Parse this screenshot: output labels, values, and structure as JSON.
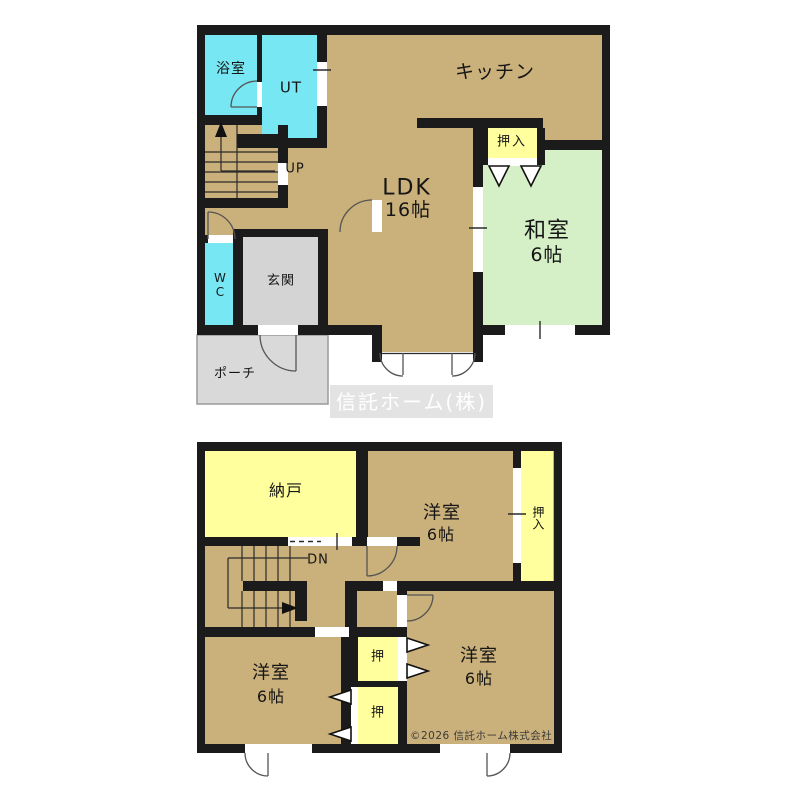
{
  "watermark": "信託ホーム(株)",
  "copyright": "©2026 信託ホーム株式会社",
  "colors": {
    "wall": "#1b1b1b",
    "room": "#cab07a",
    "water": "#77e7f4",
    "tatami": "#d5efc6",
    "closet": "#ffff9d",
    "entry": "#d4d4d4",
    "porch": "#d9d9d9"
  },
  "floor1": {
    "bath": "浴室",
    "utility": "UT",
    "kitchen": "キッチン",
    "closet": "押入",
    "washitsu": "和室",
    "washitsu_size": "6帖",
    "ldk": "LDK",
    "ldk_size": "16帖",
    "stairs_up": "UP",
    "wc": "WC",
    "entrance": "玄関",
    "porch": "ポーチ"
  },
  "floor2": {
    "storage": "納戸",
    "stairs_down": "DN",
    "yoshitsu": "洋室",
    "yoshitsu_size": "6帖",
    "oshiire": "押入",
    "oshi": "押"
  }
}
